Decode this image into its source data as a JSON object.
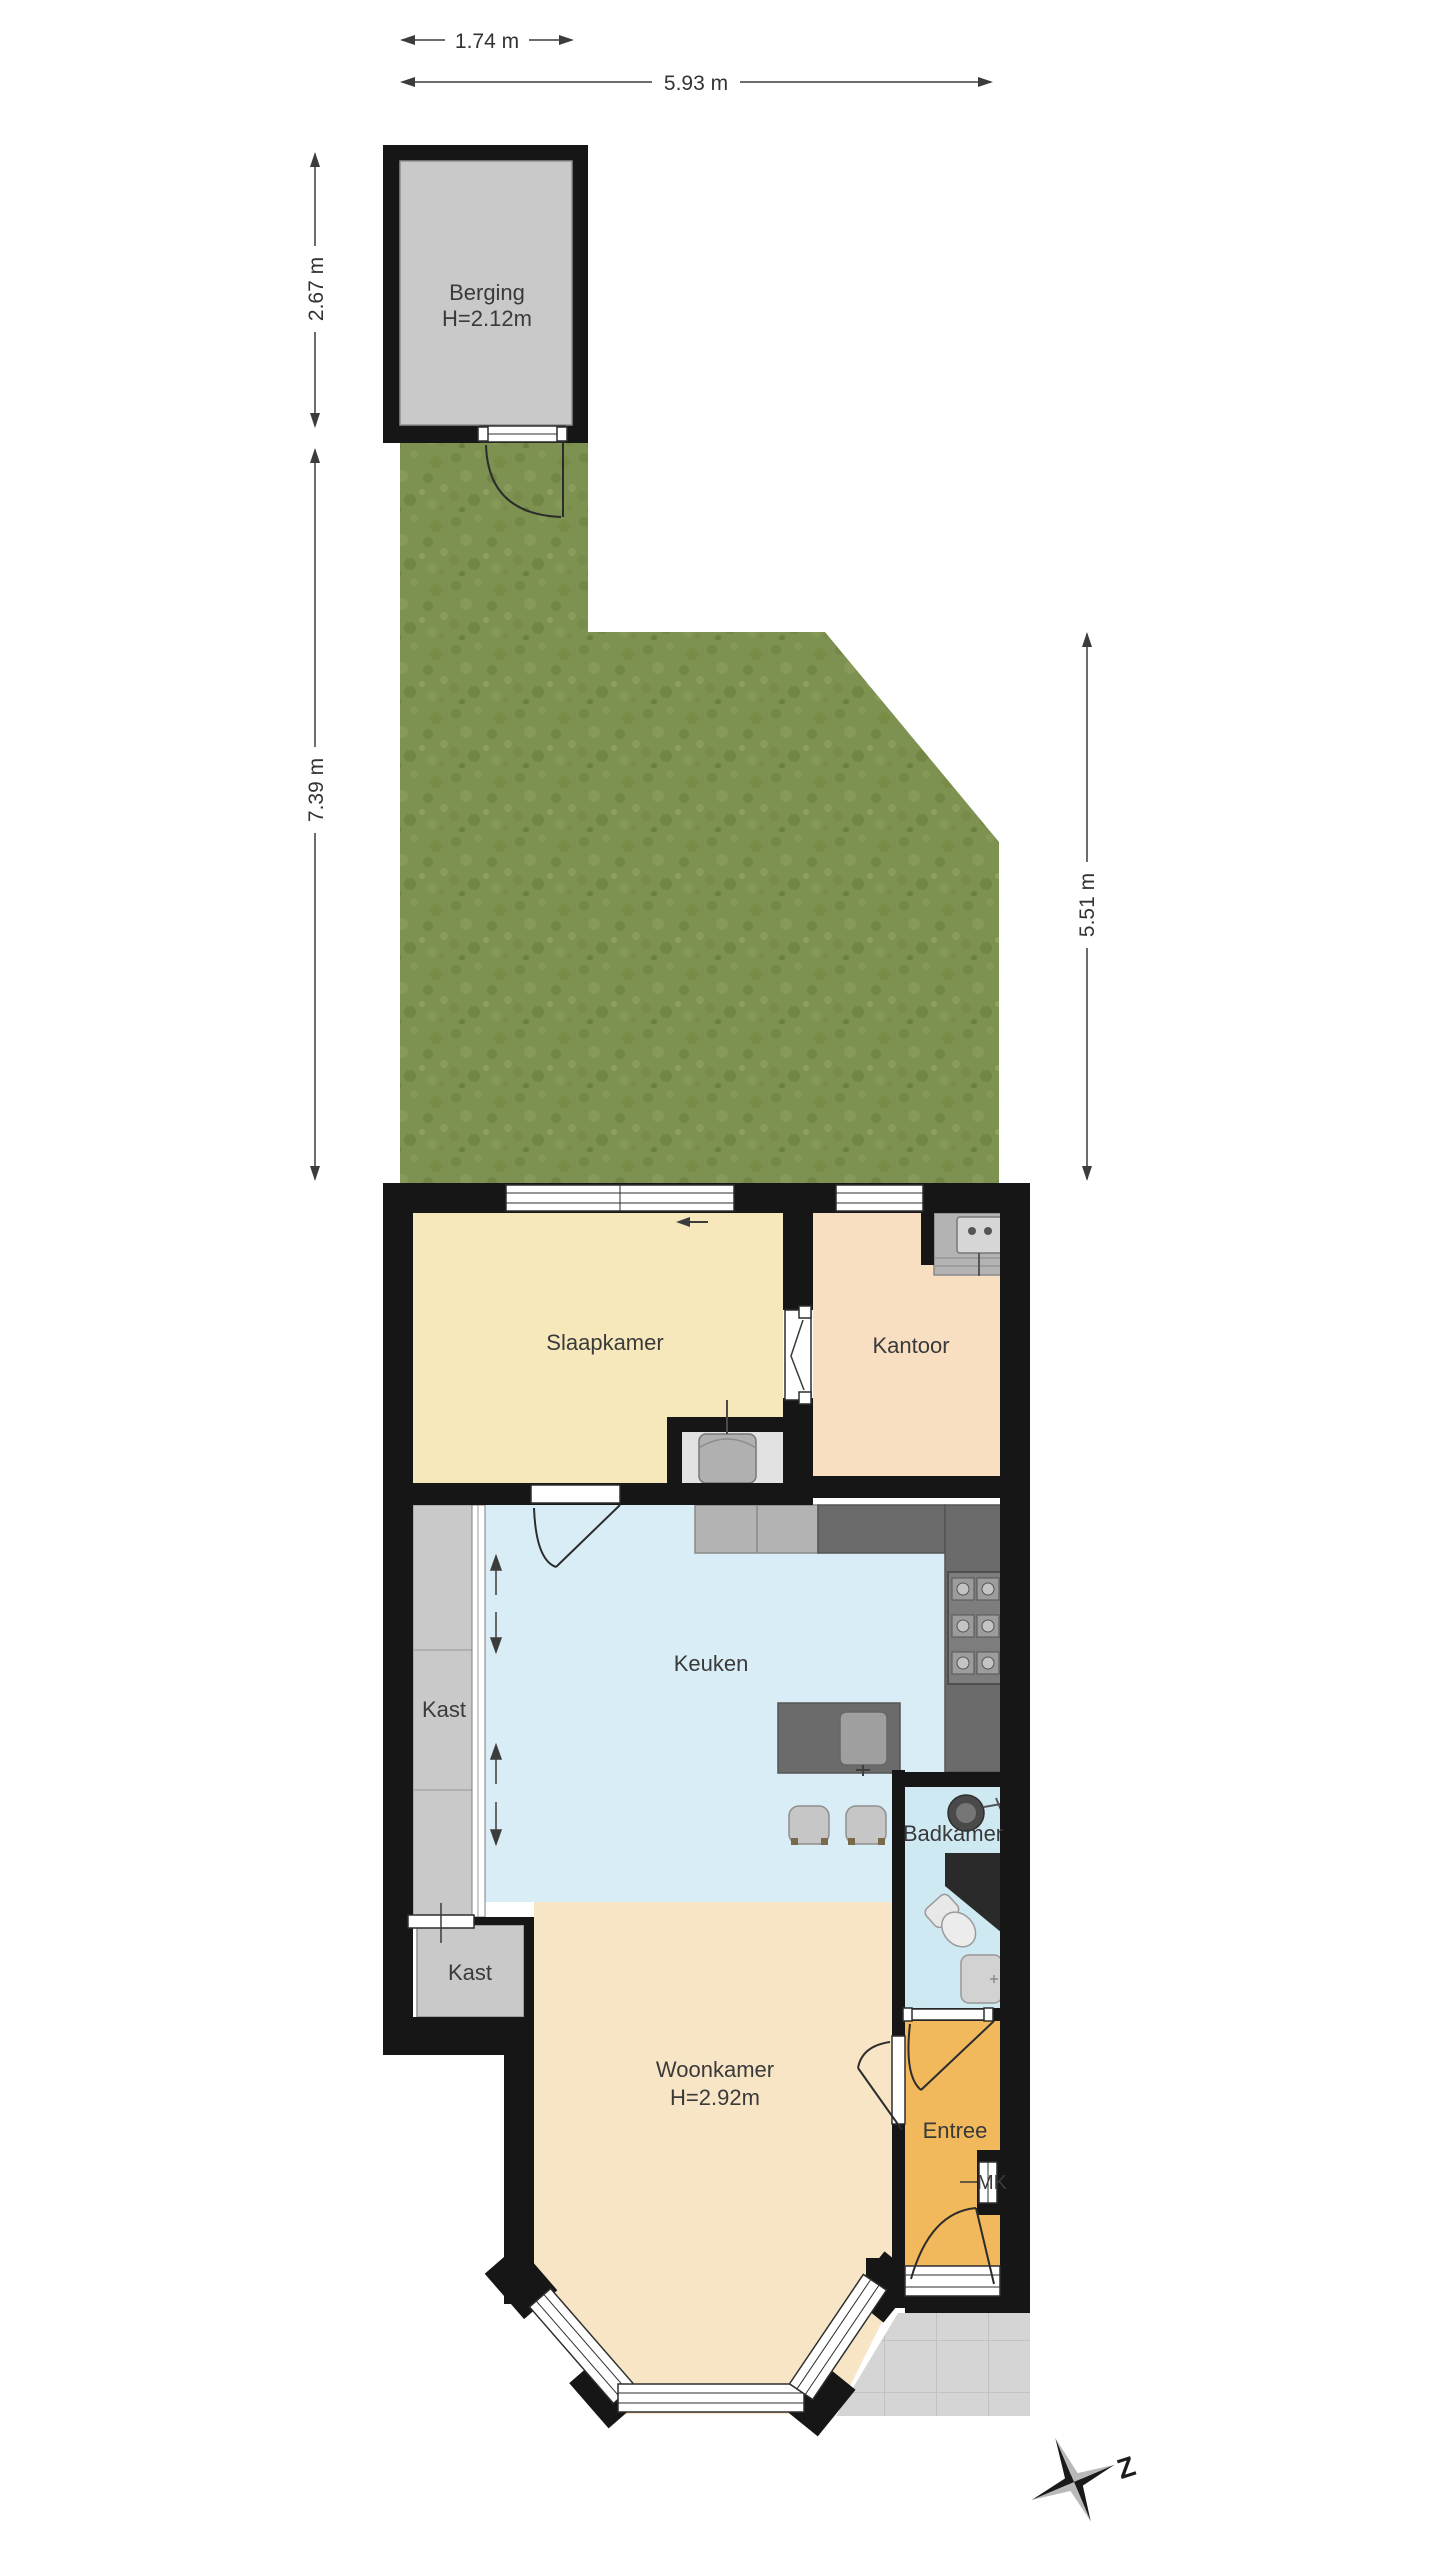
{
  "plan": {
    "dimensions": {
      "berging_width": "1.74 m",
      "total_width": "5.93 m",
      "berging_depth": "2.67 m",
      "garden_depth_left": "7.39 m",
      "garden_depth_right": "5.51 m"
    },
    "rooms": {
      "berging": {
        "name": "Berging",
        "ceiling": "H=2.12m"
      },
      "slaapkamer": {
        "name": "Slaapkamer"
      },
      "kantoor": {
        "name": "Kantoor"
      },
      "keuken": {
        "name": "Keuken"
      },
      "kast_hal": {
        "name": "Kast"
      },
      "kast_hoek": {
        "name": "Kast"
      },
      "badkamer": {
        "name": "Badkamer"
      },
      "woonkamer": {
        "name": "Woonkamer",
        "ceiling": "H=2.92m"
      },
      "entree": {
        "name": "Entree"
      },
      "meterkast": {
        "name": "MK"
      }
    },
    "compass": {
      "south": "Z"
    },
    "colors": {
      "wall": "#161616",
      "grass": "#7d9150",
      "berging_floor": "#c9c9c9",
      "slaapkamer_floor": "#f6e8bb",
      "kantoor_floor": "#f8dfc2",
      "keuken_floor": "#d9edf6",
      "badkamer_floor": "#cfe9f3",
      "woonkamer_floor": "#f8e5c6",
      "entree_floor": "#f2b95c",
      "kast_floor": "#c9c9c9",
      "counter_light": "#b3b3b3",
      "counter_dark": "#6b6b6b",
      "terrace_tile": "#d5d5d5"
    }
  }
}
